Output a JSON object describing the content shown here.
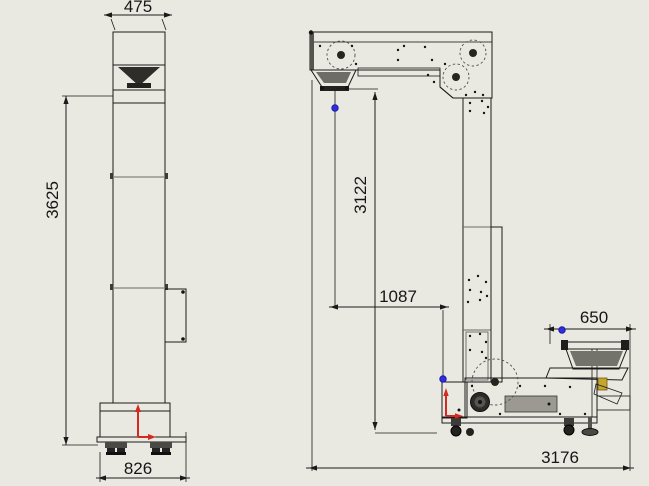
{
  "colors": {
    "background": "#eae9e1",
    "line": "#1a1a1a",
    "body_gray": "#a3a19b",
    "body_light": "#b2b1ab",
    "body_dark": "#4b4a45",
    "origin_marker_red": "#d42a20",
    "reference_point_blue": "#2f2fd8",
    "highlight_yellow": "#c6a52f"
  },
  "views": {
    "front": {
      "name": "front-view",
      "dimensions": {
        "top_width": {
          "value": "475",
          "orientation": "horizontal"
        },
        "overall_height": {
          "value": "3625",
          "orientation": "vertical"
        },
        "base_width": {
          "value": "826",
          "orientation": "horizontal"
        }
      }
    },
    "side": {
      "name": "side-view",
      "dimensions": {
        "discharge_height": {
          "value": "3122",
          "orientation": "vertical"
        },
        "discharge_offset": {
          "value": "1087",
          "orientation": "horizontal"
        },
        "infeed_width": {
          "value": "650",
          "orientation": "horizontal"
        },
        "overall_length": {
          "value": "3176",
          "orientation": "horizontal"
        }
      }
    }
  }
}
